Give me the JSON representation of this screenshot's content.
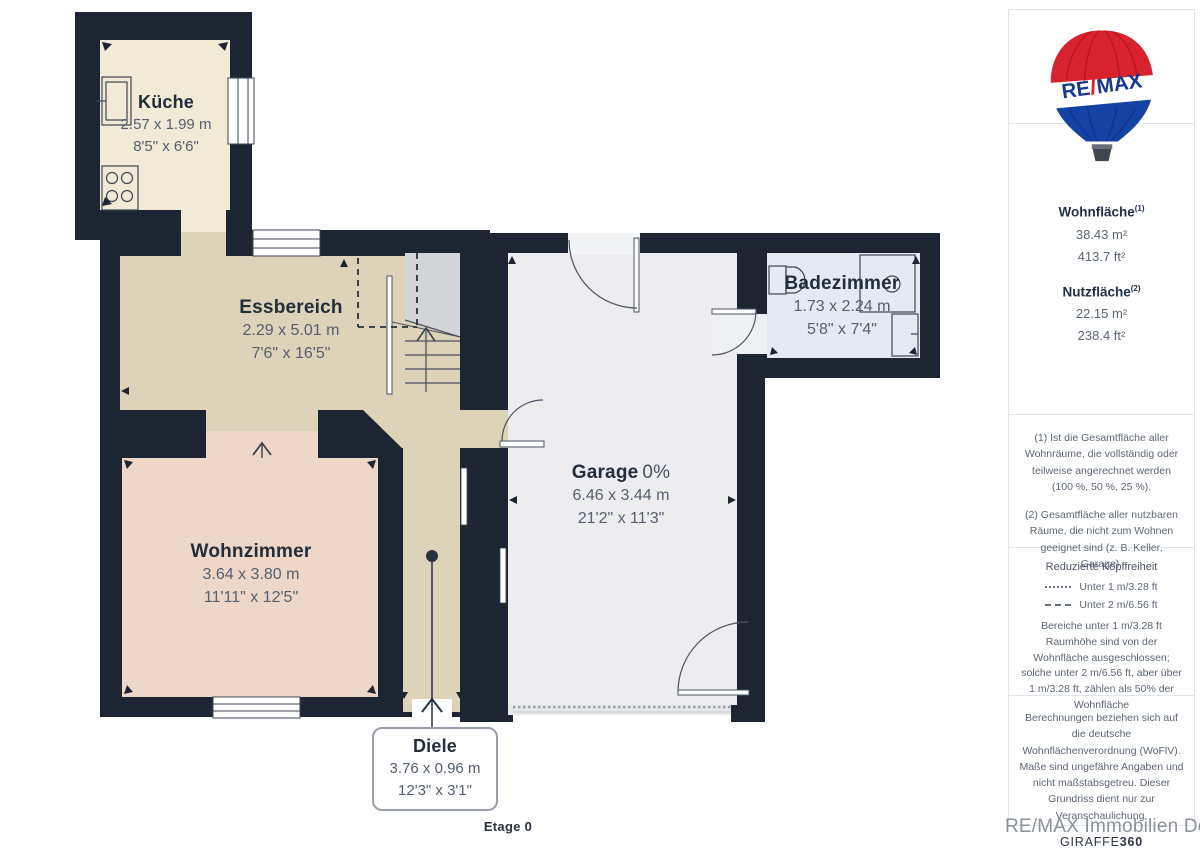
{
  "plan": {
    "floor_label": "Etage 0",
    "rooms": [
      {
        "name": "Küche",
        "size_m": "2.57 x 1.99 m",
        "size_ft": "8'5\" x 6'6\""
      },
      {
        "name": "Essbereich",
        "size_m": "2.29 x 5.01 m",
        "size_ft": "7'6\" x 16'5\""
      },
      {
        "name": "Wohnzimmer",
        "size_m": "3.64 x 3.80 m",
        "size_ft": "11'11\" x 12'5\""
      },
      {
        "name": "Garage",
        "percent": "0%",
        "size_m": "6.46 x 3.44 m",
        "size_ft": "21'2\" x 11'3\""
      },
      {
        "name": "Badezimmer",
        "size_m": "1.73 x 2.24 m",
        "size_ft": "5'8\" x 7'4\""
      },
      {
        "name": "Diele",
        "size_m": "3.76 x 0.96 m",
        "size_ft": "12'3\" x 3'1\""
      }
    ]
  },
  "sidebar": {
    "logo": {
      "re": "RE",
      "slash": "/",
      "max": "MAX"
    },
    "areas": [
      {
        "label": "Wohnfläche",
        "footnote": "(1)",
        "m2": "38.43 m²",
        "ft2": "413.7 ft²"
      },
      {
        "label": "Nutzfläche",
        "footnote": "(2)",
        "m2": "22.15 m²",
        "ft2": "238.4 ft²"
      }
    ],
    "notes": [
      "(1) Ist die Gesamtfläche aller Wohnräume, die vollständig oder teilweise angerechnet werden (100 %, 50 %, 25 %).",
      "(2) Gesamtfläche aller nutzbaren Räume, die nicht zum Wohnen geeignet sind (z. B. Keller, Garage)."
    ],
    "headroom": {
      "title": "Reduzierte Kopffreiheit",
      "legend": [
        {
          "style": "dotted",
          "label": "Unter 1 m/3.28 ft"
        },
        {
          "style": "dashed",
          "label": "Unter 2 m/6.56 ft"
        }
      ],
      "text": "Bereiche unter 1 m/3.28 ft Raumhöhe sind von der Wohnfläche ausgeschlossen; solche unter 2 m/6.56 ft, aber über 1 m/3.28 ft, zählen als 50% der Wohnfläche"
    },
    "disclaimer": "Berechnungen beziehen sich auf die deutsche Wohnflächenverordnung (WoFlV). Maße sind ungefähre Angaben und nicht maßstabsgetreu. Dieser Grundriss dient nur zur Veranschaulichung.",
    "credit": {
      "normal": "GIRAFFE",
      "bold": "360"
    }
  },
  "watermark": "RE/MAX Immobilien DeLux",
  "colors": {
    "wall": "#1c2531",
    "kitchen_floor": "#f0ead6",
    "dining_floor": "#ddd3b8",
    "living_floor": "#eed7c9",
    "garage_floor": "#ededef",
    "bath_floor": "#e4e9f2",
    "understair": "#d3d5d9",
    "remax_red": "#d8222d",
    "remax_blue": "#1543a5"
  }
}
